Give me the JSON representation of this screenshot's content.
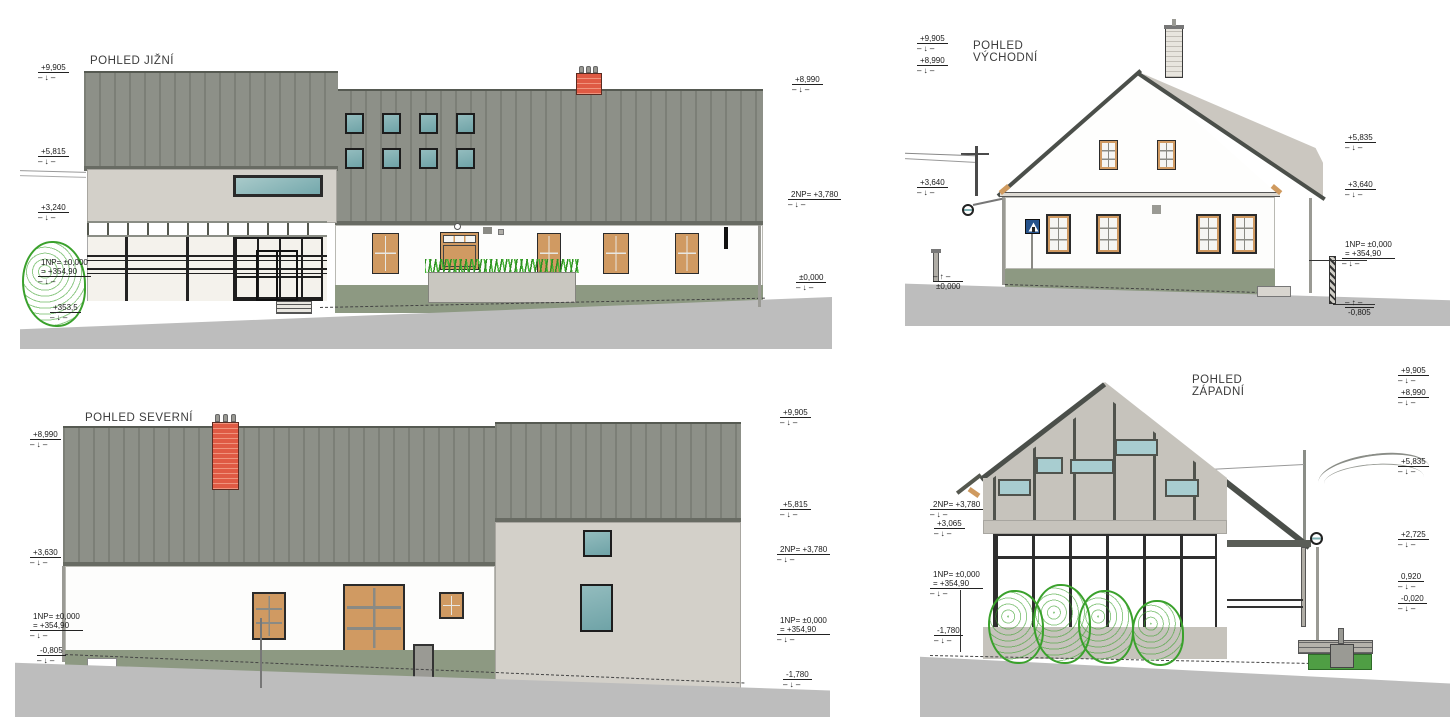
{
  "views": {
    "south": {
      "title": "POHLED JIŽNÍ",
      "dims_left": [
        {
          "label": "+9,905"
        },
        {
          "label": "+5,815"
        },
        {
          "label": "+3,240"
        },
        {
          "label": "1NP= ±0,000",
          "label2": "= +354,90"
        },
        {
          "label": "+353,5"
        }
      ],
      "dims_right": [
        {
          "label": "+8,990"
        },
        {
          "label": "2NP= +3,780"
        },
        {
          "label": "±0,000"
        }
      ]
    },
    "east": {
      "title_1": "POHLED",
      "title_2": "VÝCHODNÍ",
      "dims_left": [
        {
          "label": "+9,905"
        },
        {
          "label": "+8,990"
        },
        {
          "label": "+3,640"
        },
        {
          "label": "±0,000"
        }
      ],
      "dims_right": [
        {
          "label": "+5,835"
        },
        {
          "label": "+3,640"
        },
        {
          "label": "1NP= ±0,000",
          "label2": "= +354,90"
        },
        {
          "label": "-0,805"
        }
      ]
    },
    "north": {
      "title": "POHLED SEVERNÍ",
      "dims_left": [
        {
          "label": "+8,990"
        },
        {
          "label": "+3,630"
        },
        {
          "label": "1NP= ±0,000",
          "label2": "= +354,90"
        },
        {
          "label": "-0,805"
        }
      ],
      "dims_right": [
        {
          "label": "+9,905"
        },
        {
          "label": "+5,815"
        },
        {
          "label": "2NP= +3,780"
        },
        {
          "label": "1NP= ±0,000",
          "label2": "= +354,90"
        },
        {
          "label": "-1,780"
        }
      ]
    },
    "west": {
      "title_1": "POHLED",
      "title_2": "ZÁPADNÍ",
      "dims_left": [
        {
          "label": "2NP= +3,780"
        },
        {
          "label": "+3,065"
        },
        {
          "label": "1NP= ±0,000",
          "label2": "= +354,90"
        },
        {
          "label": "-1,780"
        }
      ],
      "dims_right": [
        {
          "label": "+9,905"
        },
        {
          "label": "+8,990"
        },
        {
          "label": "+5,835"
        },
        {
          "label": "+2,725"
        },
        {
          "label": "0,920"
        },
        {
          "label": "-0,020"
        }
      ]
    }
  },
  "colors": {
    "roof_gray": "#8d9088",
    "roof_rib": "#7c7f77",
    "roof_edge": "#4b4f4a",
    "rear_roof": "#cbc7c0",
    "modern_wall": "#d3d0c9",
    "white_wall": "#fdfdfc",
    "plinth_green": "#8d9982",
    "ground_gray": "#bdbdbd",
    "glass_teal": "#7fb2b5",
    "frame_orange": "#d09a62",
    "frame_dark": "#1d1d1d",
    "brick_red": "#df5a44",
    "sign_blue": "#26538c",
    "plant_green": "#3aa12c"
  }
}
